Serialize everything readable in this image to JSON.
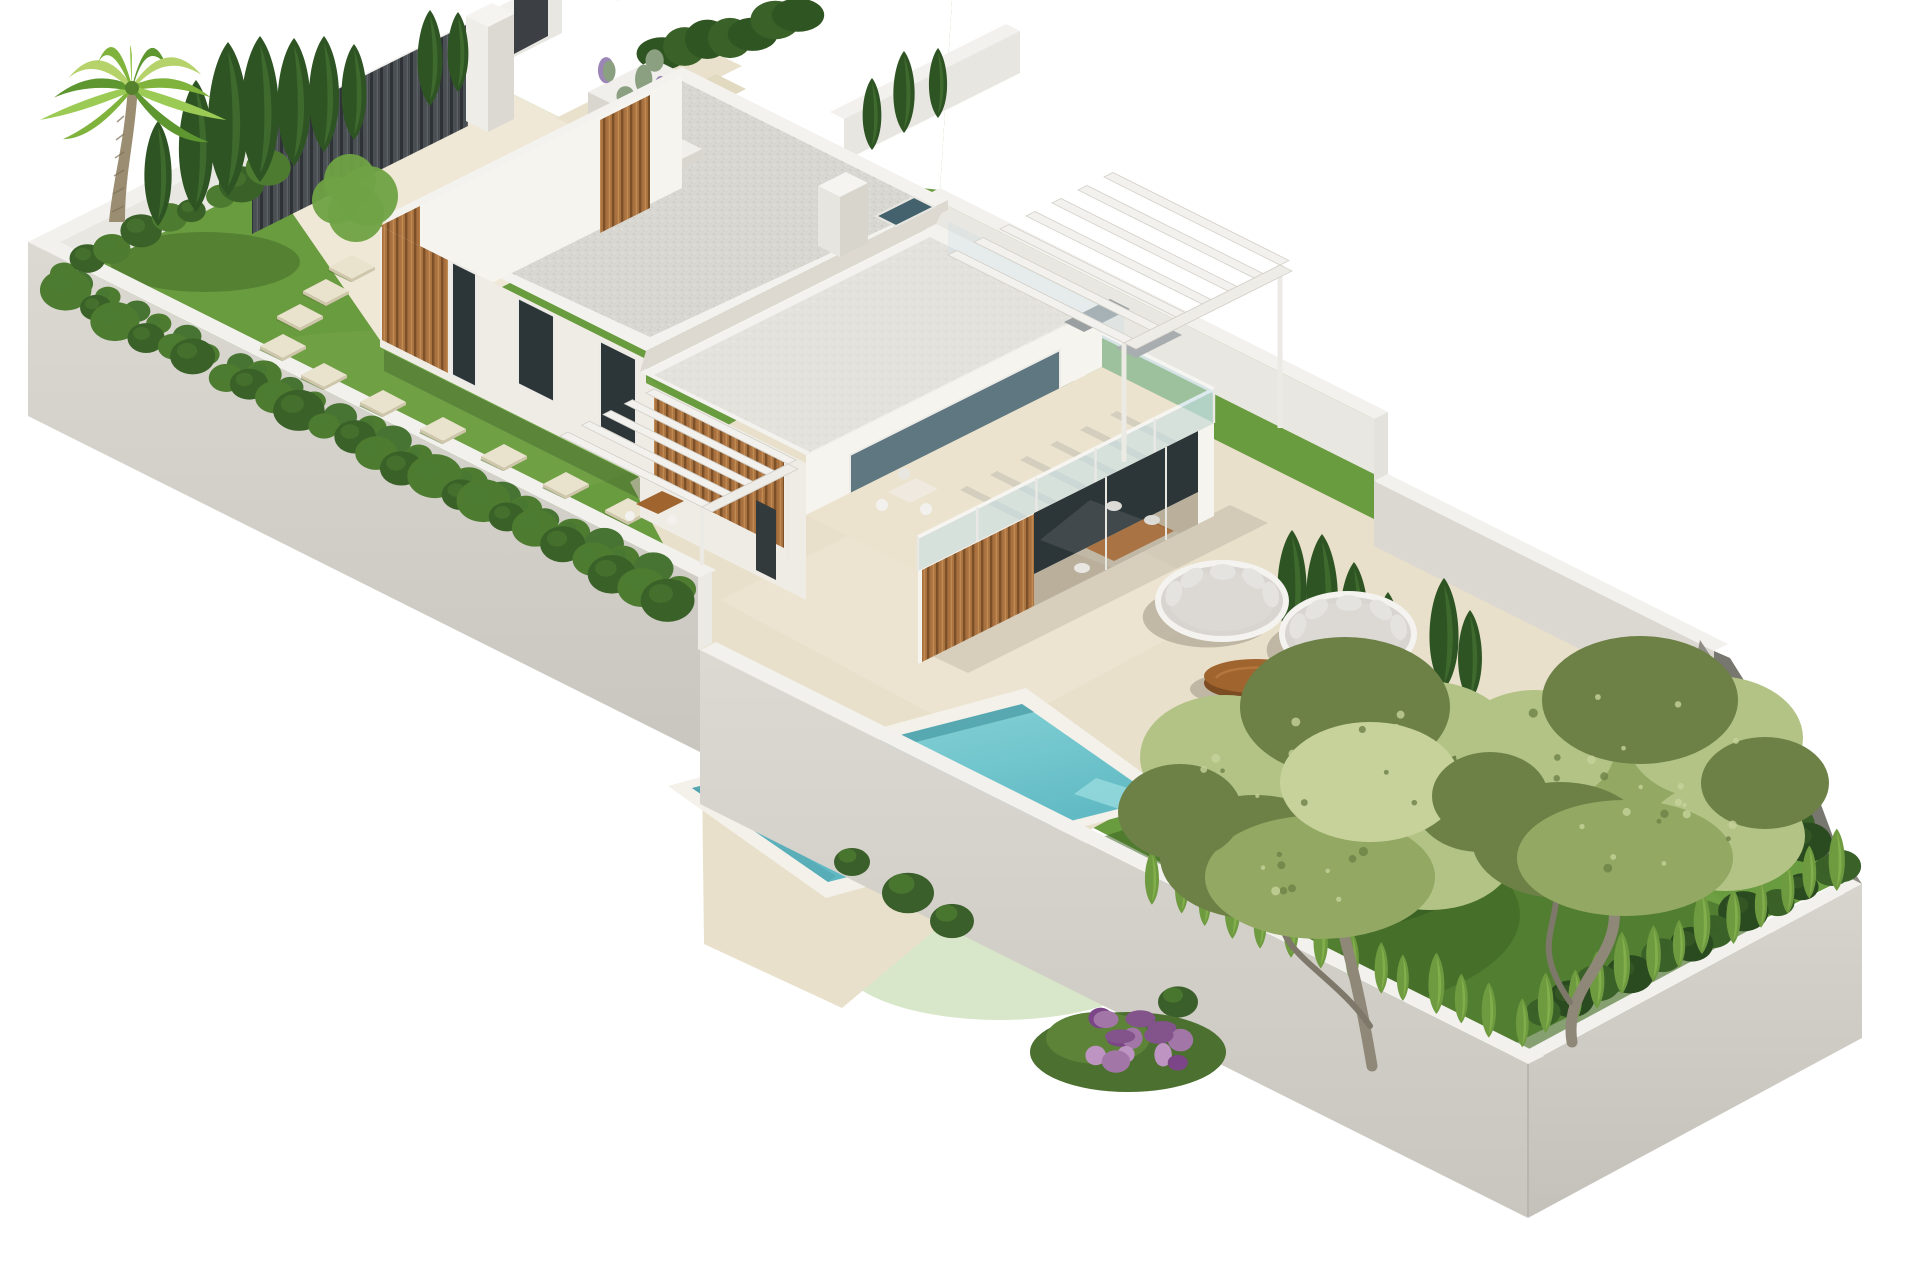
{
  "meta": {
    "title": "Isometric 3D architectural render of a modern villa plot",
    "image_type": "3d-render",
    "visible_text": "none"
  },
  "palette": {
    "bg": "#ffffff",
    "lawn": "#699b3f",
    "lawn_light": "#7fb050",
    "lawn_shadow": "#3d6323",
    "deck": "#e8e0ca",
    "deck_light": "#efe8d6",
    "deck_seam": "#d8cfb6",
    "wall_top": "#f2f1ed",
    "wall_face": "#d7d4cd",
    "wall_face_dark": "#c8c5be",
    "wall_inner": "#e9e7e1",
    "wall_inner_mid": "#dbd8d1",
    "wall_corner_dark": "#8e8d85",
    "house_white": "#f6f4ef",
    "house_light": "#efece5",
    "house_shade": "#ddd9d1",
    "roof_gravel": "#d9d7d2",
    "roof_gravel_light": "#e4e2dd",
    "parapet": "#f3f2ee",
    "wood": "#a8713f",
    "wood_dark": "#7d5128",
    "wood_light": "#c08a52",
    "glass_dark": "#2c3538",
    "glass_blue": "#44626d",
    "glass_tint": "rgba(198,224,233,0.55)",
    "pool_deep": "#5cb6c1",
    "pool_light": "#93dbde",
    "pool_coping": "#f3f1ea",
    "cushion": "#d8d5d1",
    "frame_white": "#f4f3f0",
    "table_wood": "#a0642f",
    "table_wood_dark": "#7c4c22",
    "hedge_dark": "#3a6128",
    "hedge_mid": "#4d7c31",
    "cone_light": "#8cb753",
    "cone_mid": "#6e9b3f",
    "cypress": "#2e5423",
    "cypress_light": "#477433",
    "canopy_main": "#93a862",
    "canopy_light": "#b3c386",
    "canopy_dark": "#6d8147",
    "canopy_pale": "#c6d29a",
    "flower": "#a277a8",
    "flower_dark": "#83538b",
    "flower_light": "#bd94c2",
    "gate": "#4a4f54",
    "gate_dark": "#2f3337",
    "trunk": "#8f8878",
    "palm_trunk": "#9a8d72",
    "shadow": "#3f3a30"
  },
  "scene": {
    "setting": "long rectangular walled plot seen in isometric view on a plain white background",
    "plot": {
      "perimeter_walls": "light gray rendered walls with white caps, stepped with the terrain",
      "entrance": {
        "gate": "dark vertical-slat gate",
        "pillar": "white entrance pillar",
        "planter": "white planter with lavender",
        "bin": "small dark utility box"
      }
    },
    "villa": {
      "stories": 2,
      "style": "modern white flat-roof volumes",
      "roofs": "gray gravel flat roofs with white parapets",
      "skylight_count": 1,
      "chimney_count": 1,
      "wood_slat_panels": 5,
      "pergolas": 2,
      "terrace": "first-floor terrace with glass balustrade",
      "indoor_dining_chairs": 4
    },
    "pool": {
      "shape": "rectangular",
      "coping": "white",
      "water": "turquoise"
    },
    "furniture": {
      "round_daybeds": [
        {
          "cx": 1222,
          "cy": 601,
          "rx": 64,
          "ry": 38
        },
        {
          "cx": 1348,
          "cy": 634,
          "rx": 66,
          "ry": 40
        }
      ],
      "coffee_table": {
        "cx": 1256,
        "cy": 676
      },
      "terrace_set": {
        "cx": 906,
        "cy": 494
      },
      "sun_loungers": [
        {
          "x": 1080,
          "y": 318
        },
        {
          "x": 1132,
          "y": 343
        }
      ]
    },
    "garden_left": {
      "palm": {
        "base": [
          116,
          222
        ],
        "top": [
          132,
          86
        ],
        "fronds": 11
      },
      "cypress_columns": [
        [
          158,
          226,
          105
        ],
        [
          196,
          212,
          132
        ],
        [
          228,
          196,
          154
        ],
        [
          260,
          182,
          146
        ],
        [
          294,
          166,
          128
        ],
        [
          324,
          152,
          116
        ],
        [
          354,
          140,
          96
        ],
        [
          430,
          106,
          96
        ],
        [
          458,
          92,
          80
        ]
      ],
      "bush_tree_blobs": [
        [
          350,
          180,
          26
        ],
        [
          368,
          196,
          30
        ],
        [
          336,
          200,
          24
        ],
        [
          356,
          214,
          28
        ]
      ],
      "stepping_stones": [
        [
          628,
          510
        ],
        [
          566,
          484
        ],
        [
          504,
          456
        ],
        [
          443,
          429
        ],
        [
          383,
          402
        ],
        [
          324,
          375
        ],
        [
          283,
          346
        ],
        [
          300,
          316
        ],
        [
          326,
          291
        ],
        [
          352,
          267
        ]
      ]
    },
    "garden_right": {
      "trees": [
        {
          "trunk": [
            [
              1372,
              1066
            ],
            [
              1338,
              912
            ]
          ],
          "canopy_center": [
            1330,
            802
          ]
        },
        {
          "trunk": [
            [
              1572,
              1042
            ],
            [
              1612,
              896
            ]
          ],
          "canopy_center": [
            1630,
            788
          ]
        }
      ],
      "canopy_blobs_1": [
        [
          0,
          0,
          170,
          115,
          0
        ],
        [
          -105,
          -45,
          85,
          62,
          1
        ],
        [
          95,
          -55,
          92,
          66,
          1
        ],
        [
          15,
          -95,
          105,
          70,
          2
        ],
        [
          -75,
          55,
          95,
          62,
          2
        ],
        [
          100,
          50,
          85,
          58,
          1
        ],
        [
          -10,
          75,
          115,
          62,
          0
        ],
        [
          -150,
          10,
          62,
          48,
          2
        ],
        [
          150,
          0,
          66,
          50,
          2
        ],
        [
          40,
          -20,
          90,
          60,
          3
        ]
      ],
      "canopy_blobs_2": [
        [
          0,
          0,
          160,
          108,
          0
        ],
        [
          -95,
          -40,
          80,
          58,
          1
        ],
        [
          85,
          -50,
          88,
          62,
          1
        ],
        [
          10,
          -88,
          98,
          64,
          2
        ],
        [
          -70,
          52,
          88,
          58,
          2
        ],
        [
          95,
          48,
          80,
          55,
          1
        ],
        [
          -5,
          70,
          108,
          58,
          0
        ],
        [
          135,
          -5,
          64,
          46,
          2
        ],
        [
          -140,
          8,
          58,
          44,
          2
        ]
      ],
      "flower_shrub": {
        "cx": 1128,
        "cy": 1044
      },
      "small_bushes": [
        [
          908,
          893,
          26
        ],
        [
          952,
          921,
          22
        ],
        [
          852,
          862,
          18
        ],
        [
          1178,
          1002,
          20
        ]
      ]
    },
    "hedges": {
      "nw_row": {
        "from": [
          64,
          278
        ],
        "to": [
          272,
          176
        ],
        "n": 9,
        "r": 17
      },
      "sw_row": {
        "from": [
          66,
          302
        ],
        "to": [
          668,
          606
        ],
        "n": 24,
        "r": 21
      },
      "corner_dark_a": {
        "from": [
          1640,
          712
        ],
        "to": [
          1836,
          872
        ],
        "n": 9,
        "r": 24
      },
      "corner_dark_b": {
        "from": [
          1830,
          880
        ],
        "to": [
          1545,
          1022
        ],
        "n": 11,
        "r": 22
      },
      "cone_row_sw": {
        "from": [
          1150,
          905
        ],
        "to": [
          1520,
          1046
        ],
        "n": 14
      },
      "cone_row_se": {
        "from": [
          1545,
          1035
        ],
        "to": [
          1838,
          888
        ],
        "n": 12
      },
      "ne_cypress_low": [
        [
          1292,
          642,
          112
        ],
        [
          1322,
          656,
          122
        ],
        [
          1354,
          670,
          108
        ],
        [
          1388,
          688,
          96
        ],
        [
          1444,
          690,
          112
        ],
        [
          1470,
          702,
          92
        ]
      ],
      "ne_cypress_yard": [
        [
          1030,
          478,
          122
        ],
        [
          1066,
          498,
          132
        ],
        [
          1100,
          516,
          112
        ]
      ],
      "neighbor_cypress": [
        [
          872,
          150,
          72
        ],
        [
          904,
          133,
          82
        ],
        [
          938,
          118,
          70
        ]
      ]
    }
  }
}
